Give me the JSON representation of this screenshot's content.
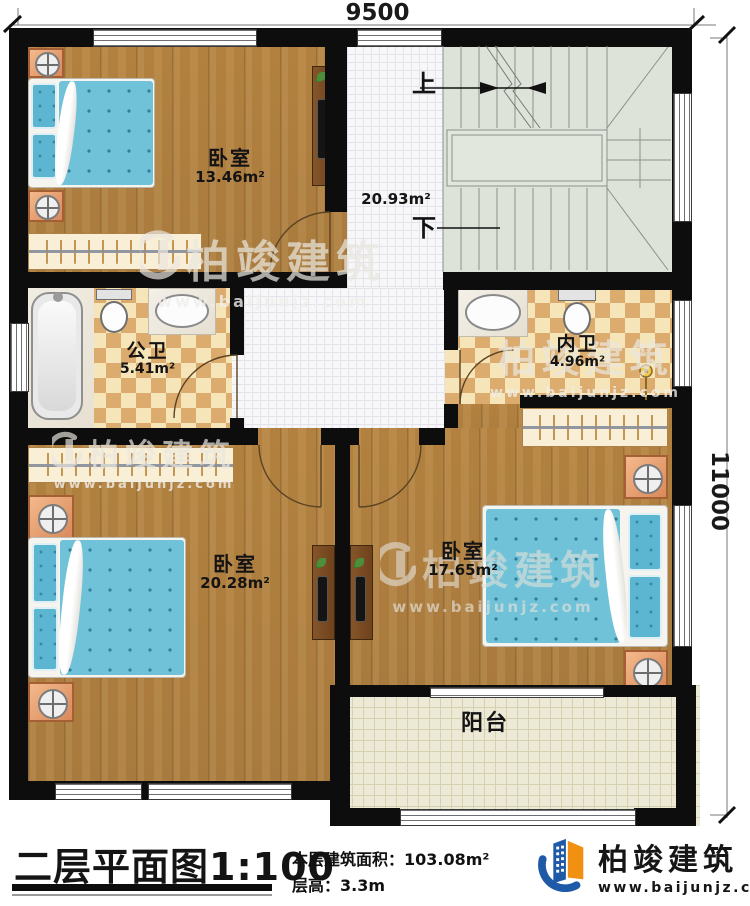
{
  "dimensions": {
    "width_top": "9500",
    "height_right": "11000"
  },
  "stair_labels": {
    "up": "上",
    "down": "下"
  },
  "rooms": {
    "bedroom_top_left": {
      "name": "卧室",
      "area": "13.46m²"
    },
    "hall": {
      "area": "20.93m²"
    },
    "public_bath": {
      "name": "公卫",
      "area": "5.41m²"
    },
    "private_bath": {
      "name": "内卫",
      "area": "4.96m²"
    },
    "bedroom_bottom_left": {
      "name": "卧室",
      "area": "20.28m²"
    },
    "bedroom_bottom_right": {
      "name": "卧室",
      "area": "17.65m²"
    },
    "balcony": {
      "name": "阳台"
    }
  },
  "watermark": {
    "brand": "柏竣建筑",
    "url": "www.baijunjz.com"
  },
  "title_block": {
    "plan_title": "二层平面图",
    "scale": "1:100",
    "area_label": "本层建筑面积：",
    "area_value": "103.08m²",
    "height_label": "层高：",
    "height_value": "3.3m"
  },
  "logo": {
    "brand": "柏竣建筑",
    "url": "www.baijunjz.com"
  },
  "colors": {
    "wall": "#0d0d0d",
    "wood": "#ab7c3e",
    "bath_tile_dark": "#dcab6e",
    "bath_tile_light": "#f6e5b8",
    "stairs": "#dde3d9",
    "mattress": "#70c2d8",
    "logo_blue": "#1e5aa8",
    "logo_orange": "#f29111"
  }
}
